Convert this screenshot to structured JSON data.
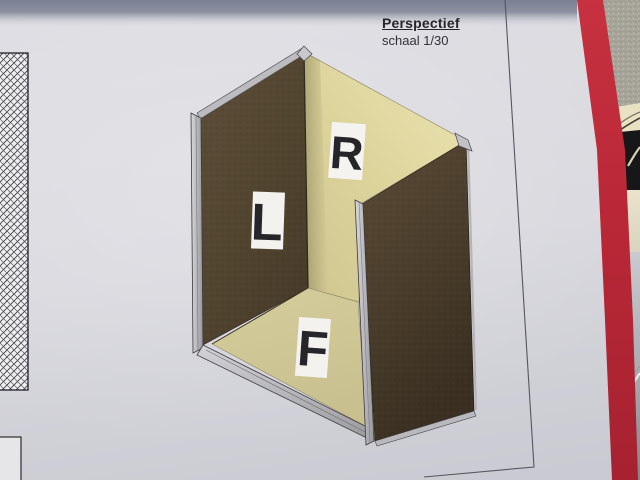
{
  "document": {
    "title": "Perspectief",
    "scale": "schaal 1/30"
  },
  "drawing": {
    "view": "perspective cabinet carcass",
    "labels": {
      "left_panel": "L",
      "right_panel": "R",
      "floor": "F"
    }
  },
  "colors": {
    "panel_exterior_brown": "#52432f",
    "panel_interior_cream": "#ddd5a4",
    "aluminum_edge": "#c2c2c6",
    "red_stripe": "#bf2836",
    "paper": "#d8d8dd"
  }
}
